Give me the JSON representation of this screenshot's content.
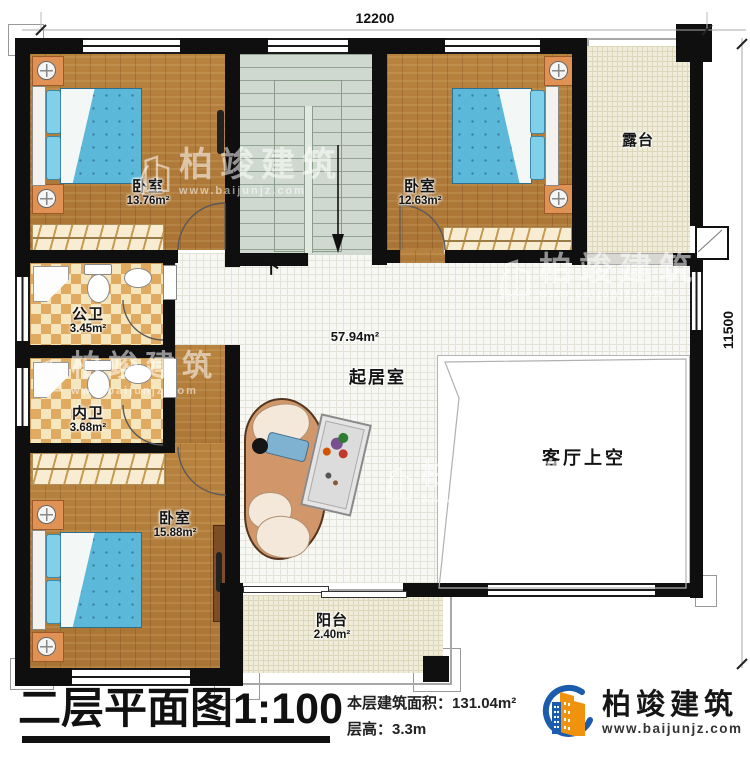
{
  "dimensions": {
    "top": "12200",
    "right": "11500"
  },
  "rooms": {
    "bedroom1": {
      "name": "卧室",
      "area": "13.76m²"
    },
    "bedroom2": {
      "name": "卧室",
      "area": "12.63m²"
    },
    "bedroom3": {
      "name": "卧室",
      "area": "15.88m²"
    },
    "terrace": {
      "name": "露台"
    },
    "public_bath": {
      "name": "公卫",
      "area": "3.45m²"
    },
    "private_bath": {
      "name": "内卫",
      "area": "3.68m²"
    },
    "living": {
      "name": "起居室",
      "area": "57.94m²"
    },
    "living_void": {
      "name": "客厅上空"
    },
    "balcony": {
      "name": "阳台",
      "area": "2.40m²"
    }
  },
  "stairs": {
    "down_label": "下"
  },
  "title_block": {
    "title": "二层平面图1:100",
    "area_label": "本层建筑面积：",
    "area_value": "131.04m²",
    "height_label": "层高：",
    "height_value": "3.3m"
  },
  "logo": {
    "company": "柏竣建筑",
    "website": "www.baijunjz.com"
  },
  "watermark": {
    "company": "柏竣建筑",
    "website": "www.baijunjz.com"
  },
  "colors": {
    "wall": "#0f0f0f",
    "wood_floor": "#b27c3c",
    "bed": "#5cb8d8",
    "stair_floor": "#cfd9cf",
    "tile_dark": "#e0ab60",
    "tile_light": "#f6e6bd",
    "outdoor_floor": "#efecda",
    "logo_blue": "#1c5cad",
    "logo_orange": "#f0920e"
  }
}
